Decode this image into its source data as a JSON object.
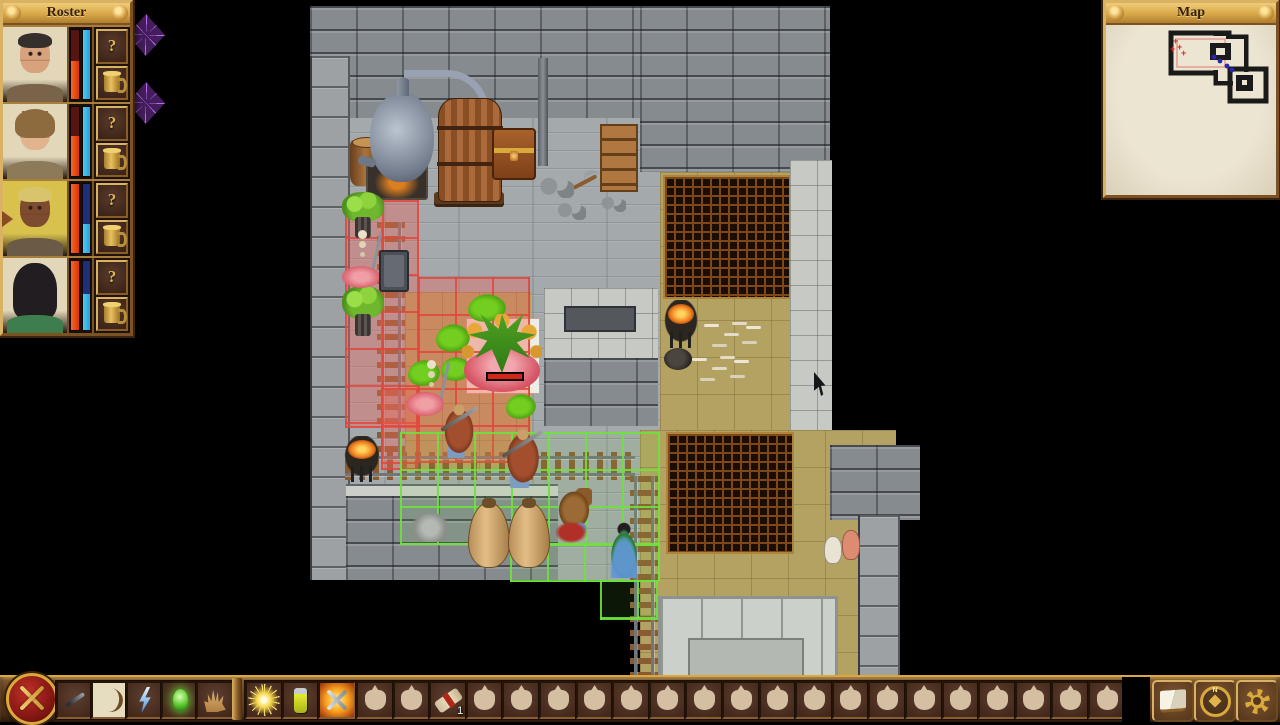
{
  "roster": {
    "title": "Roster",
    "question_label": "?",
    "characters": [
      {
        "id": "char-1",
        "bg": "#e3d7ba",
        "skin": "#d7a27c",
        "hair": "#35302c",
        "shirt": "#79644a",
        "hair_style": "short",
        "hp_pct": 55,
        "mp_pct": 100,
        "active": false
      },
      {
        "id": "char-2",
        "bg": "#e3d7ba",
        "skin": "#e2b48e",
        "hair": "#8d6b3f",
        "shirt": "#8d7a58",
        "hair_style": "bob",
        "hp_pct": 58,
        "mp_pct": 100,
        "active": false
      },
      {
        "id": "char-3",
        "bg": "#d9c14e",
        "skin": "#7d4c2e",
        "hair": "#d9c46e",
        "shirt": "#6b5a46",
        "hair_style": "short",
        "hp_pct": 100,
        "mp_pct": 42,
        "active": true
      },
      {
        "id": "char-4",
        "bg": "#e3d7ba",
        "skin": "#ecd0b8",
        "hair": "#211d21",
        "shirt": "#3e7d4d",
        "hair_style": "long",
        "hp_pct": 100,
        "mp_pct": 52,
        "active": false
      }
    ]
  },
  "map_panel": {
    "title": "Map",
    "enemy_color": "#d03028",
    "party_color": "#2828a8",
    "viewport_color": "#e89a96",
    "enemy_marks": [
      [
        67,
        16
      ],
      [
        71,
        22
      ],
      [
        75,
        28
      ],
      [
        64,
        24
      ]
    ],
    "party_marks": [
      [
        108,
        32
      ],
      [
        114,
        36
      ],
      [
        121,
        41
      ],
      [
        126,
        45
      ]
    ]
  },
  "toolbar": {
    "left_slots": [
      {
        "icon": "dagger",
        "name": "melee-weapon-slot"
      },
      {
        "icon": "bow",
        "name": "ranged-weapon-slot",
        "selected": true
      },
      {
        "icon": "lightning",
        "name": "spell-lightning-slot"
      },
      {
        "icon": "gem",
        "name": "spell-gem-slot"
      },
      {
        "icon": "hand",
        "name": "loot-hand-slot"
      }
    ],
    "mid_slots": [
      {
        "icon": "sunburst",
        "name": "light-spell-slot"
      },
      {
        "icon": "potion",
        "name": "potion-slot"
      },
      {
        "icon": "flaming-swords",
        "name": "attack-mode-slot",
        "active": true
      }
    ],
    "bag_count": 21,
    "special_bag": {
      "index": 2,
      "icon": "scroll",
      "count": "1",
      "name": "scroll-item-slot"
    },
    "right_buttons": [
      {
        "icon": "book",
        "name": "journal-button"
      },
      {
        "icon": "compass",
        "name": "world-map-button"
      },
      {
        "icon": "gear",
        "name": "settings-button"
      }
    ]
  },
  "scene": {
    "floors": [
      {
        "t": "plank",
        "x": 310,
        "y": 6,
        "w": 520,
        "h": 574
      },
      {
        "t": "tan",
        "x": 405,
        "y": 292,
        "w": 126,
        "h": 178
      },
      {
        "t": "brick",
        "x": 310,
        "y": 6,
        "w": 520,
        "h": 112
      },
      {
        "t": "brick",
        "x": 640,
        "y": 6,
        "w": 190,
        "h": 166
      },
      {
        "t": "wallcol",
        "x": 310,
        "y": 56,
        "w": 36,
        "h": 524
      },
      {
        "t": "lightwall",
        "x": 544,
        "y": 288,
        "w": 114,
        "h": 74
      },
      {
        "t": "bench",
        "x": 564,
        "y": 306,
        "w": 68,
        "h": 22
      },
      {
        "t": "brick",
        "x": 544,
        "y": 358,
        "w": 114,
        "h": 68
      },
      {
        "t": "ledge",
        "x": 346,
        "y": 484,
        "w": 212,
        "h": 14
      },
      {
        "t": "brick",
        "x": 346,
        "y": 496,
        "w": 212,
        "h": 84
      },
      {
        "t": "tan",
        "x": 660,
        "y": 172,
        "w": 130,
        "h": 258
      },
      {
        "t": "grate",
        "x": 663,
        "y": 175,
        "w": 124,
        "h": 120
      },
      {
        "t": "lightwall",
        "x": 790,
        "y": 160,
        "w": 42,
        "h": 285
      },
      {
        "t": "tan",
        "x": 640,
        "y": 430,
        "w": 256,
        "h": 252
      },
      {
        "t": "grate",
        "x": 666,
        "y": 432,
        "w": 124,
        "h": 118
      },
      {
        "t": "brick",
        "x": 830,
        "y": 445,
        "w": 90,
        "h": 75
      },
      {
        "t": "wallcol",
        "x": 858,
        "y": 515,
        "w": 38,
        "h": 170
      },
      {
        "t": "platform",
        "x": 658,
        "y": 596,
        "w": 174,
        "h": 88
      },
      {
        "t": "platform-inner",
        "x": 688,
        "y": 638,
        "w": 112,
        "h": 46
      },
      {
        "t": "pillar",
        "x": 538,
        "y": 58,
        "w": 10,
        "h": 108
      }
    ],
    "rails": [
      {
        "t": "rail-v",
        "x": 377,
        "y": 222,
        "w": 28,
        "h": 236
      },
      {
        "t": "rail-h",
        "x": 345,
        "y": 452,
        "w": 290,
        "h": 28
      },
      {
        "t": "rail-v",
        "x": 630,
        "y": 476,
        "w": 28,
        "h": 208
      }
    ],
    "highlights": [
      {
        "t": "sel-white",
        "x": 466,
        "y": 318,
        "w": 74,
        "h": 76
      },
      {
        "t": "hl-red",
        "x": 345,
        "y": 200,
        "w": 74,
        "h": 228
      },
      {
        "t": "hl-red",
        "x": 381,
        "y": 388,
        "w": 37,
        "h": 82
      },
      {
        "t": "hl-red",
        "x": 418,
        "y": 277,
        "w": 112,
        "h": 186
      },
      {
        "t": "hl-green",
        "x": 400,
        "y": 432,
        "w": 260,
        "h": 113
      },
      {
        "t": "hl-green",
        "x": 510,
        "y": 544,
        "w": 150,
        "h": 38
      },
      {
        "t": "hl-green",
        "x": 600,
        "y": 580,
        "w": 58,
        "h": 40
      }
    ],
    "objects": [
      {
        "t": "bucket",
        "x": 350,
        "y": 140,
        "w": 34,
        "h": 46
      },
      {
        "t": "furnace",
        "x": 366,
        "y": 158,
        "w": 58,
        "h": 38
      },
      {
        "t": "pipe",
        "x": 404,
        "y": 70,
        "w": 78,
        "h": 52
      },
      {
        "t": "alembic",
        "x": 370,
        "y": 92,
        "w": 64,
        "h": 90
      },
      {
        "t": "vat-stand",
        "x": 434,
        "y": 192,
        "w": 70,
        "h": 12
      },
      {
        "t": "vat",
        "x": 438,
        "y": 98,
        "w": 62,
        "h": 102
      },
      {
        "t": "chest",
        "x": 492,
        "y": 128,
        "w": 40,
        "h": 48
      },
      {
        "t": "shelf",
        "x": 600,
        "y": 124,
        "w": 34,
        "h": 64
      },
      {
        "t": "pickaxe",
        "x": 568,
        "y": 170,
        "w": 32,
        "h": 26
      },
      {
        "t": "rubble",
        "x": 538,
        "y": 172,
        "w": 36,
        "h": 26
      },
      {
        "t": "rubble",
        "x": 556,
        "y": 198,
        "w": 30,
        "h": 22
      },
      {
        "t": "rubble",
        "x": 600,
        "y": 192,
        "w": 26,
        "h": 20
      },
      {
        "t": "mushroom",
        "x": 342,
        "y": 192,
        "w": 42,
        "h": 46
      },
      {
        "t": "mushroom",
        "x": 342,
        "y": 286,
        "w": 42,
        "h": 50
      },
      {
        "t": "skeleton",
        "x": 348,
        "y": 230,
        "w": 30,
        "h": 52
      },
      {
        "t": "puddle",
        "x": 342,
        "y": 266,
        "w": 38,
        "h": 22
      },
      {
        "t": "minecart",
        "x": 379,
        "y": 250,
        "w": 26,
        "h": 38
      },
      {
        "t": "splat",
        "x": 468,
        "y": 294,
        "w": 38,
        "h": 28
      },
      {
        "t": "splat",
        "x": 436,
        "y": 324,
        "w": 34,
        "h": 28
      },
      {
        "t": "splat",
        "x": 408,
        "y": 360,
        "w": 32,
        "h": 26
      },
      {
        "t": "splat",
        "x": 441,
        "y": 357,
        "w": 30,
        "h": 24
      },
      {
        "t": "splat",
        "x": 506,
        "y": 394,
        "w": 30,
        "h": 25
      },
      {
        "t": "skeleton",
        "x": 418,
        "y": 360,
        "w": 28,
        "h": 50
      },
      {
        "t": "puddle",
        "x": 406,
        "y": 392,
        "w": 38,
        "h": 24
      },
      {
        "t": "plant",
        "x": 462,
        "y": 314,
        "w": 80,
        "h": 82
      },
      {
        "t": "hpbar",
        "x": 486,
        "y": 372,
        "w": 36,
        "h": 7
      },
      {
        "t": "warrior",
        "x": 440,
        "y": 402,
        "w": 38,
        "h": 56
      },
      {
        "t": "warrior",
        "x": 502,
        "y": 426,
        "w": 42,
        "h": 62
      },
      {
        "t": "brazier",
        "x": 340,
        "y": 436,
        "w": 44,
        "h": 46
      },
      {
        "t": "urn",
        "x": 468,
        "y": 502,
        "w": 40,
        "h": 64
      },
      {
        "t": "urn",
        "x": 508,
        "y": 502,
        "w": 40,
        "h": 64
      },
      {
        "t": "critter",
        "x": 556,
        "y": 488,
        "w": 36,
        "h": 40
      },
      {
        "t": "remains",
        "x": 554,
        "y": 518,
        "w": 38,
        "h": 26
      },
      {
        "t": "heroine",
        "x": 604,
        "y": 520,
        "w": 40,
        "h": 58
      },
      {
        "t": "relief",
        "x": 404,
        "y": 514,
        "w": 52,
        "h": 28
      },
      {
        "t": "bones",
        "x": 700,
        "y": 318,
        "w": 64,
        "h": 34
      },
      {
        "t": "bones",
        "x": 688,
        "y": 352,
        "w": 76,
        "h": 34
      },
      {
        "t": "brazier",
        "x": 660,
        "y": 300,
        "w": 42,
        "h": 48
      },
      {
        "t": "pot",
        "x": 664,
        "y": 348,
        "w": 28,
        "h": 22
      },
      {
        "t": "jug-white",
        "x": 824,
        "y": 536,
        "w": 16,
        "h": 26
      },
      {
        "t": "jug-pink",
        "x": 842,
        "y": 530,
        "w": 16,
        "h": 28
      },
      {
        "t": "web",
        "x": 127,
        "y": 14,
        "w": 38,
        "h": 42
      },
      {
        "t": "web",
        "x": 127,
        "y": 82,
        "w": 38,
        "h": 42
      },
      {
        "t": "cursor",
        "x": 814,
        "y": 372,
        "w": 16,
        "h": 24
      }
    ]
  }
}
